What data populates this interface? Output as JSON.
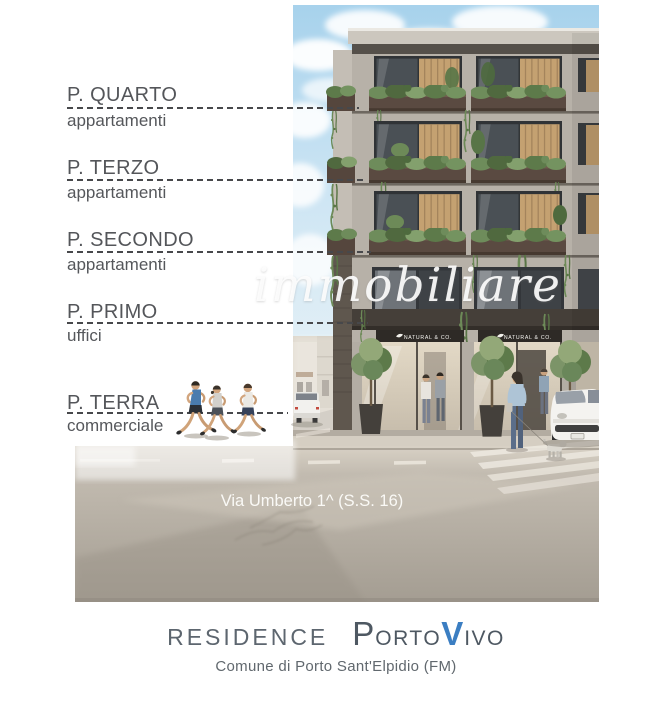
{
  "annotations": {
    "floors": [
      {
        "title": "P. QUARTO",
        "subtitle": "appartamenti"
      },
      {
        "title": "P. TERZO",
        "subtitle": "appartamenti"
      },
      {
        "title": "P. SECONDO",
        "subtitle": "appartamenti"
      },
      {
        "title": "P. PRIMO",
        "subtitle": "uffici"
      },
      {
        "title": "P. TERRA",
        "subtitle": "commerciale"
      }
    ]
  },
  "render": {
    "watermark": "immobiliare",
    "street_name": "Via Umberto 1^ (S.S. 16)",
    "storefront_sign": "NATURAL & CO."
  },
  "footer": {
    "residence": "RESIDENCE",
    "brand_p": "P",
    "brand_orto": "ORTO",
    "brand_v": "V",
    "brand_ivo": "IVO",
    "subtitle": "Comune di Porto Sant'Elpidio (FM)",
    "accent_blue": "#3b7ec2"
  }
}
